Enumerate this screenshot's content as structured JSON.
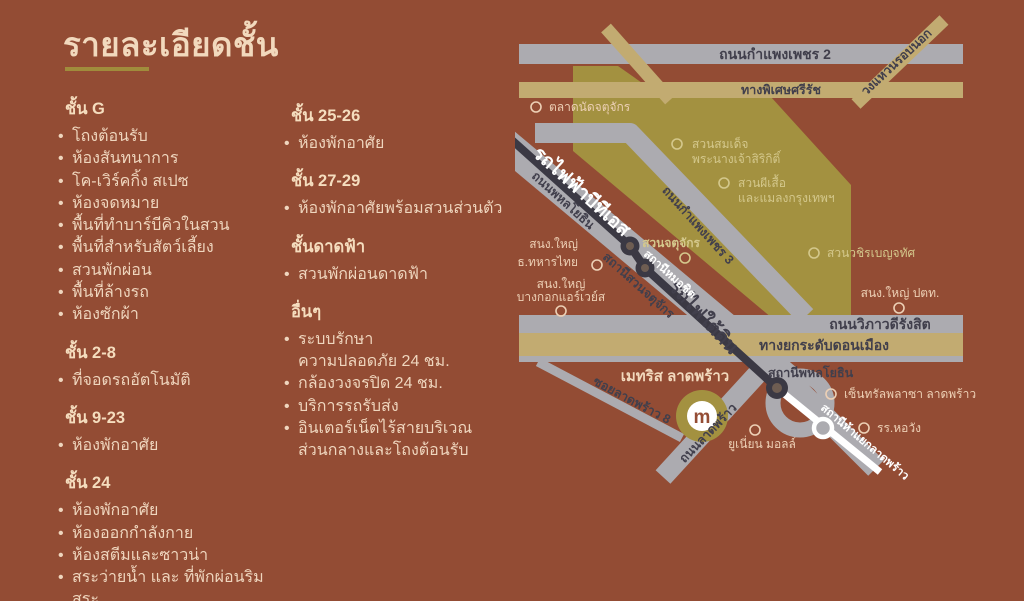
{
  "page": {
    "title": "รายละเอียดชั้น"
  },
  "floors": {
    "column1": [
      {
        "header": "ชั้น G",
        "items": [
          "โถงต้อนรับ",
          "ห้องสันทนาการ",
          "โค-เวิร์คกิ้ง สเปซ",
          "ห้องจดหมาย",
          "พื้นที่ทำบาร์บีคิวในสวน",
          "พื้นที่สำหรับสัตว์เลี้ยง",
          "สวนพักผ่อน",
          "พื้นที่ล้างรถ",
          "ห้องซักผ้า"
        ]
      },
      {
        "header": "ชั้น 2-8",
        "items": [
          "ที่จอดรถอัตโนมัติ"
        ]
      },
      {
        "header": "ชั้น 9-23",
        "items": [
          "ห้องพักอาศัย"
        ]
      },
      {
        "header": "ชั้น 24",
        "items": [
          "ห้องพักอาศัย",
          "ห้องออกกำลังกาย",
          "ห้องสตีมและซาวน่า",
          "สระว่ายน้ำ และ ที่พักผ่อนริมสระ"
        ]
      }
    ],
    "column2": [
      {
        "header": "ชั้น 25-26",
        "items": [
          "ห้องพักอาศัย"
        ]
      },
      {
        "header": "ชั้น 27-29",
        "items": [
          "ห้องพักอาศัยพร้อมสวนส่วนตัว"
        ]
      },
      {
        "header": "ชั้นดาดฟ้า",
        "items": [
          "สวนพักผ่อนดาดฟ้า"
        ]
      },
      {
        "header": "อื่นๆ",
        "items": [
          "ระบบรักษา\nความปลอดภัย 24 ชม.",
          "กล้องวงจรปิด 24 ชม.",
          "บริการรถรับส่ง",
          "อินเตอร์เน็ตไร้สายบริเวณ\nส่วนกลางและโถงต้อนรับ"
        ]
      }
    ]
  },
  "map": {
    "roads": {
      "kamphaeng_phet_2": "ถนนกำแพงเพชร 2",
      "si_rat_expressway": "ทางพิเศษศรีรัช",
      "outer_ring_road": "วงแหวนรอบนอก",
      "kamphaeng_phet_3": "ถนนกำแพงเพชร 3",
      "phahonyothin_road": "ถนนพหลโยธิน",
      "vibhavadi_rangsit": "ถนนวิภาวดีรังสิต",
      "don_mueang_tollway": "ทางยกระดับดอนเมือง",
      "ladprao_road": "ถนนลาดพร้าว",
      "soi_ladprao_8": "ซอยลาดพร้าว 8"
    },
    "transit": {
      "bts_line": "รถไฟฟ้าบีทีเอส",
      "subway_line": "รถไฟใต้ดิน",
      "station_mo_chit": "สถานีหมอชิต",
      "station_chatuchak_park": "สถานีสวนจตุจักร",
      "station_phahonyothin": "สถานีพหลโยธิน",
      "station_ha_yaek_ladprao": "สถานีห้าแยกลาดพร้าว"
    },
    "places": {
      "chatuchak_market": "ตลาดนัดจตุจักร",
      "queen_sirikit_park_1": "สวนสมเด็จ",
      "queen_sirikit_park_2": "พระนางเจ้าสิริกิติ์",
      "butterfly_garden_1": "สวนผีเสื้อ",
      "butterfly_garden_2": "และแมลงกรุงเทพฯ",
      "chatuchak_park": "สวนจตุจักร",
      "wachirabenchathat_park": "สวนวชิรเบญจทัศ",
      "tmb_hq_1": "สนง.ใหญ่",
      "tmb_hq_2": "ธ.ทหารไทย",
      "bangkok_airways_hq_1": "สนง.ใหญ่",
      "bangkok_airways_hq_2": "บางกอกแอร์เวย์ส",
      "ptt_hq": "สนง.ใหญ่ ปตท.",
      "central_plaza_ladprao": "เซ็นทรัลพลาซา ลาดพร้าว",
      "horwang_school": "รร.หอวัง",
      "union_mall": "ยูเนี่ยน มอลล์"
    },
    "project": {
      "name": "เมทริส ลาดพร้าว",
      "logo_letter": "m"
    },
    "colors": {
      "background_brown": "#934C34",
      "accent_gold": "#A08C3C",
      "text_cream": "#EFD6BE",
      "park_olive": "#A39140",
      "road_gray": "#ACABB0",
      "road_tan": "#C2AB71",
      "transit_dark": "#3B3944",
      "transit_white": "#FFFFFF"
    }
  }
}
